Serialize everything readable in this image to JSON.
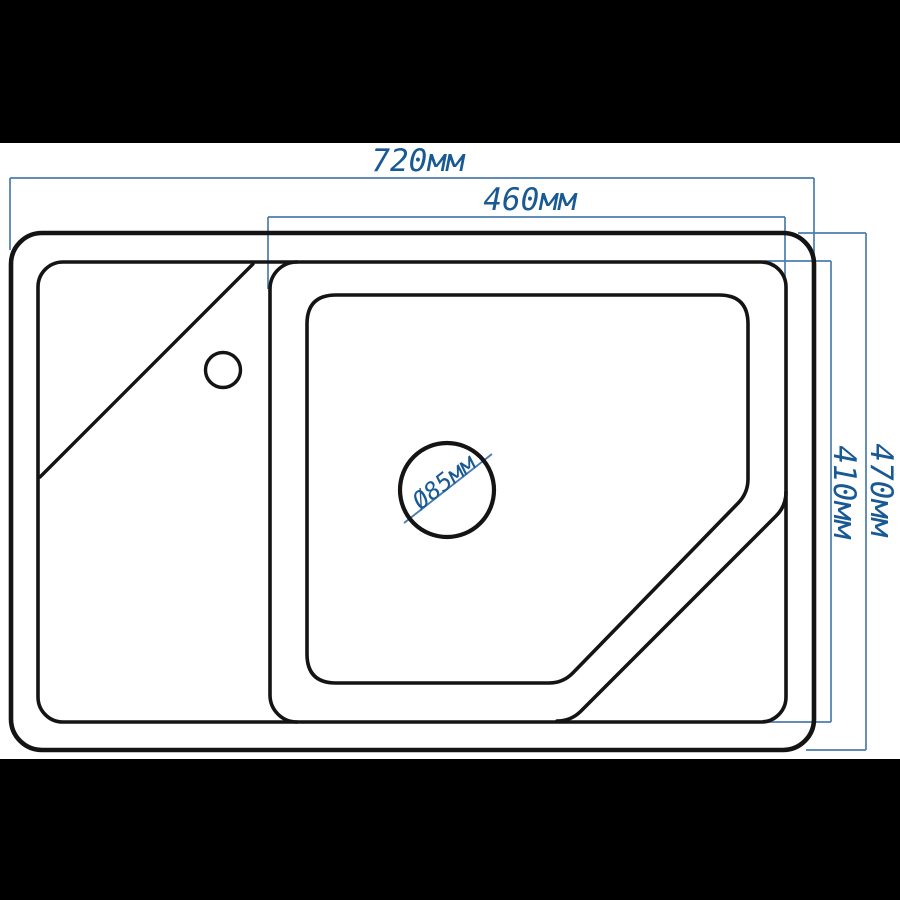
{
  "page": {
    "background_color": "#ffffff",
    "letterbox_color": "#000000"
  },
  "drawing": {
    "description": "kitchen sink top-view technical dimension drawing",
    "outline_color": "#141414",
    "dimension_line_color": "#4b7dad",
    "dimension_text_color": "#1a5a94",
    "dimensions": {
      "overall_width": "720мм",
      "bowl_width": "460мм",
      "overall_depth": "470мм",
      "bowl_depth": "410мм",
      "drain_diameter": "Ø85мм"
    }
  }
}
